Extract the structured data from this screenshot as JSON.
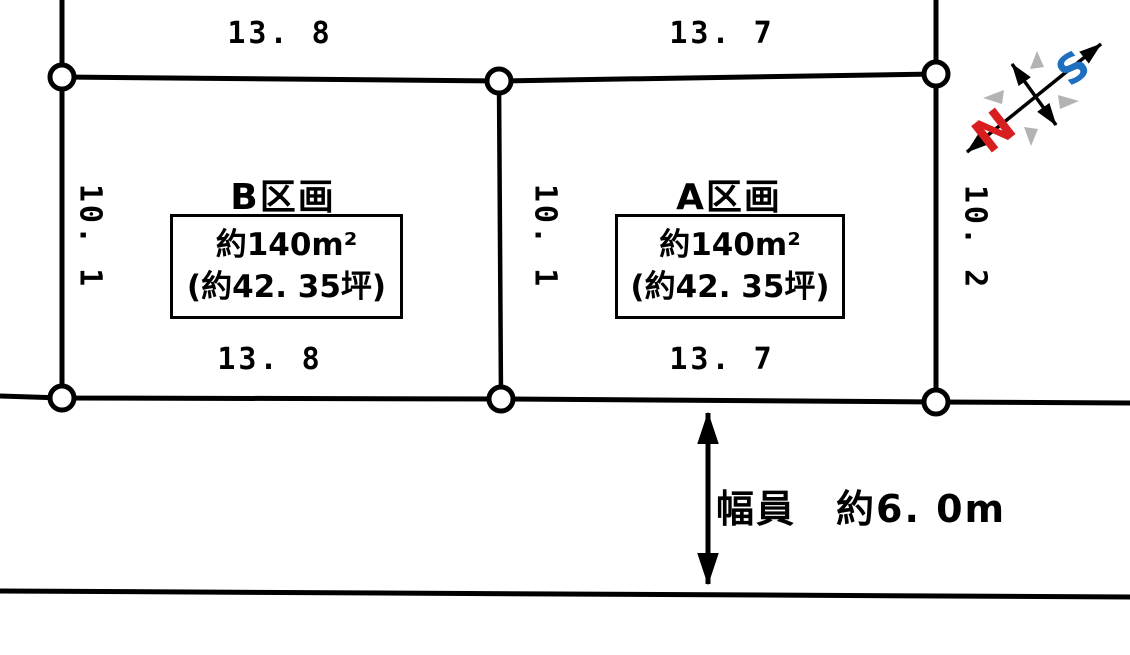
{
  "parcels": [
    {
      "title": "B区画",
      "area": "約140m²",
      "area_tsubo": "(約42. 35坪)",
      "top_dim": "13. 8",
      "bottom_dim": "13. 8"
    },
    {
      "title": "A区画",
      "area": "約140m²",
      "area_tsubo": "(約42. 35坪)",
      "top_dim": "13. 7",
      "bottom_dim": "13. 7"
    }
  ],
  "side_dims": {
    "left": "10. 1",
    "middle": "10. 1",
    "right": "10. 2"
  },
  "road": {
    "width_label": "幅員　約6. 0m"
  },
  "compass": {
    "north": "N",
    "south": "S"
  },
  "colors": {
    "line": "#000000",
    "north": "#d81e1e",
    "south": "#1e6fbf",
    "compass_tick": "#b3b3b3",
    "background": "#ffffff"
  }
}
